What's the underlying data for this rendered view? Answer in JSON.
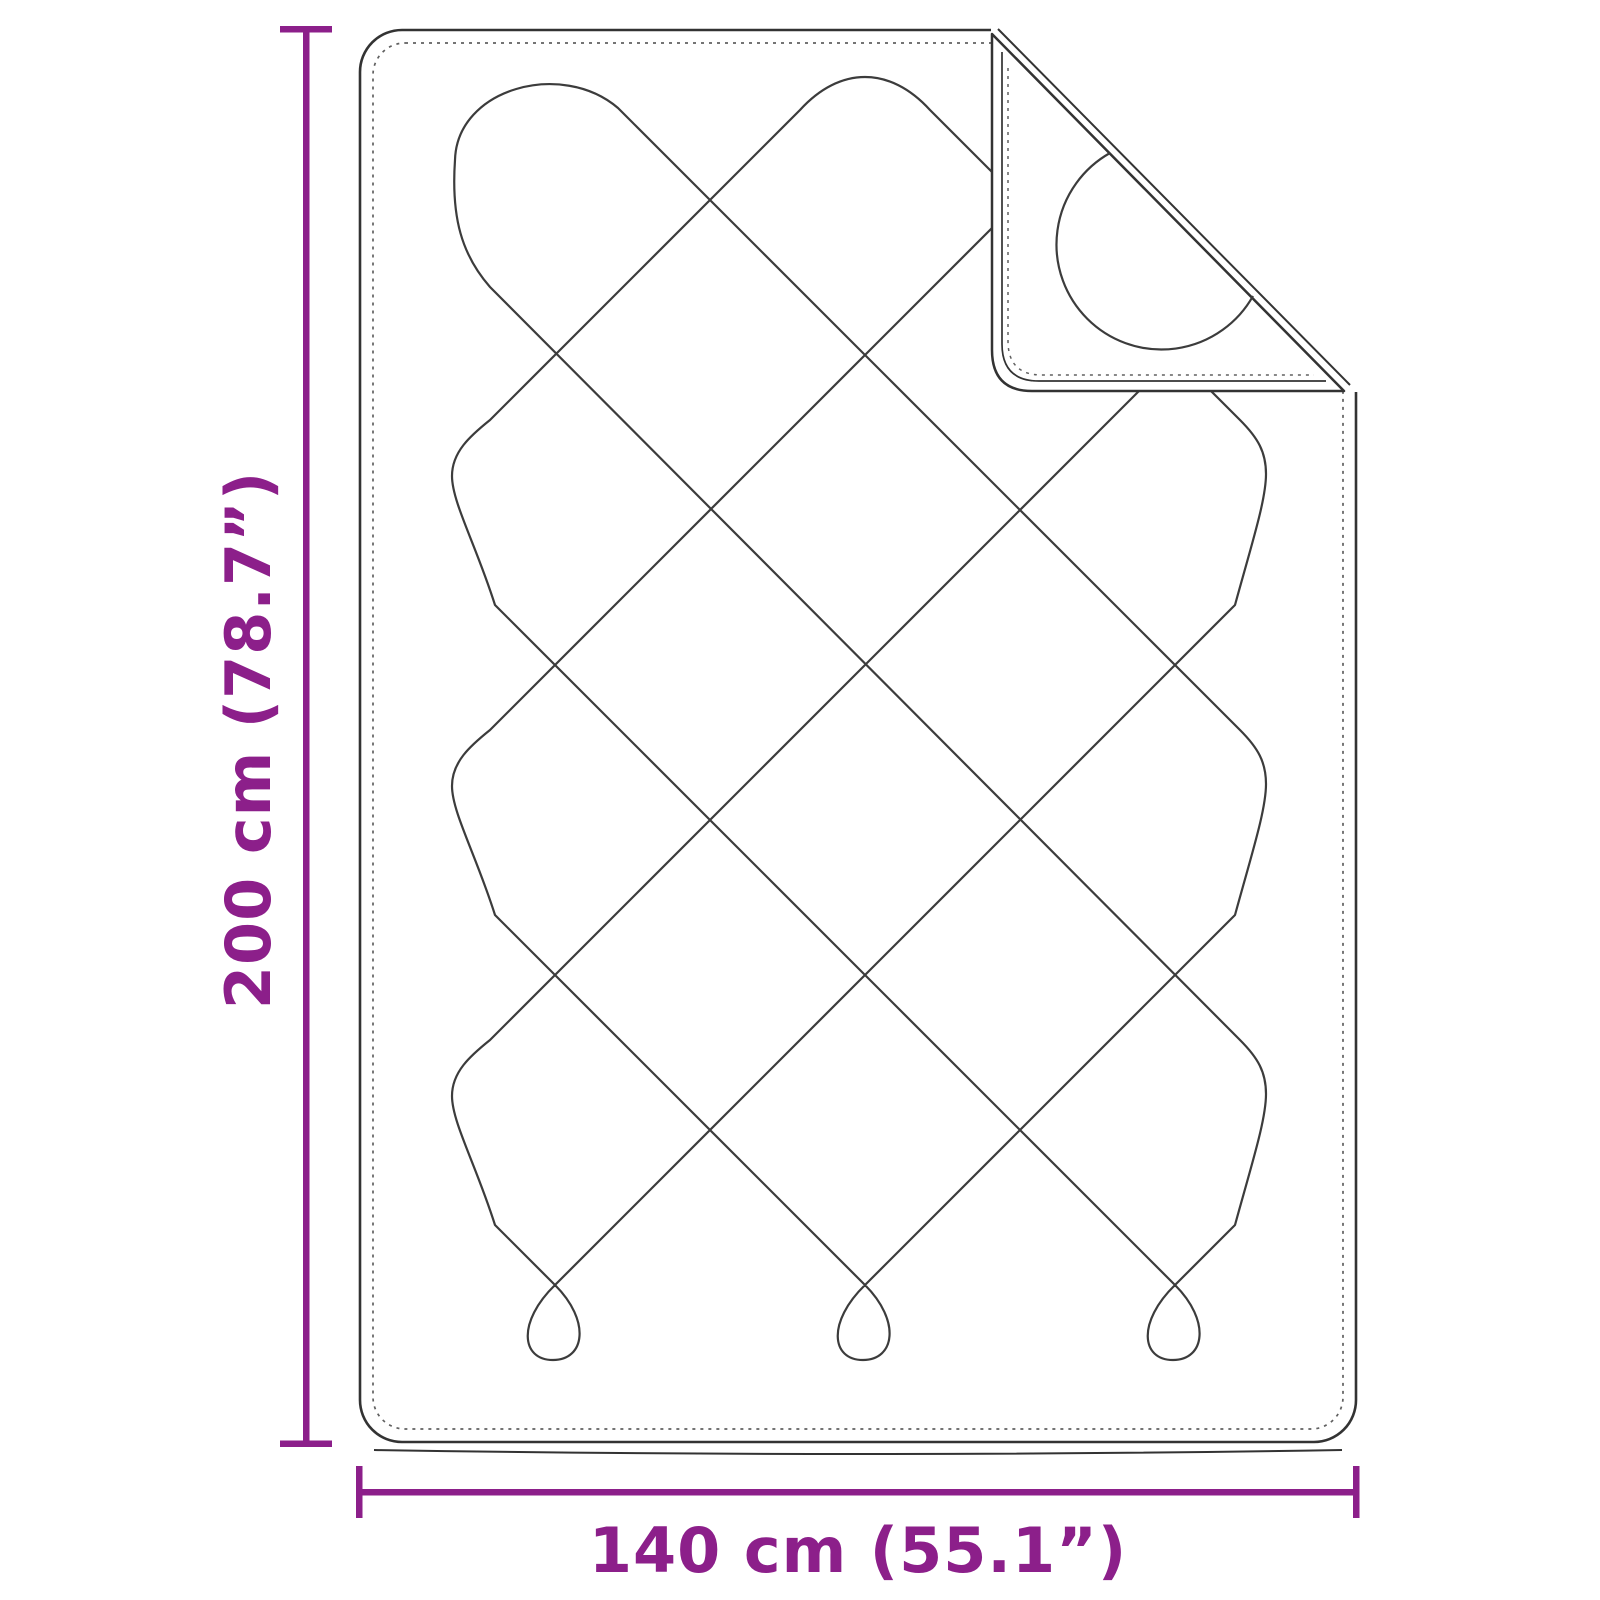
{
  "figure": {
    "name": "quilted-blanket-dimension-diagram",
    "height_label": "200 cm (78.7”)",
    "width_label": "140 cm (55.1”)"
  },
  "colors": {
    "accent": "#8c1f8a",
    "outline": "#333333",
    "stitch": "#3c3c3c",
    "dashed": "#606060",
    "background": "#ffffff"
  }
}
